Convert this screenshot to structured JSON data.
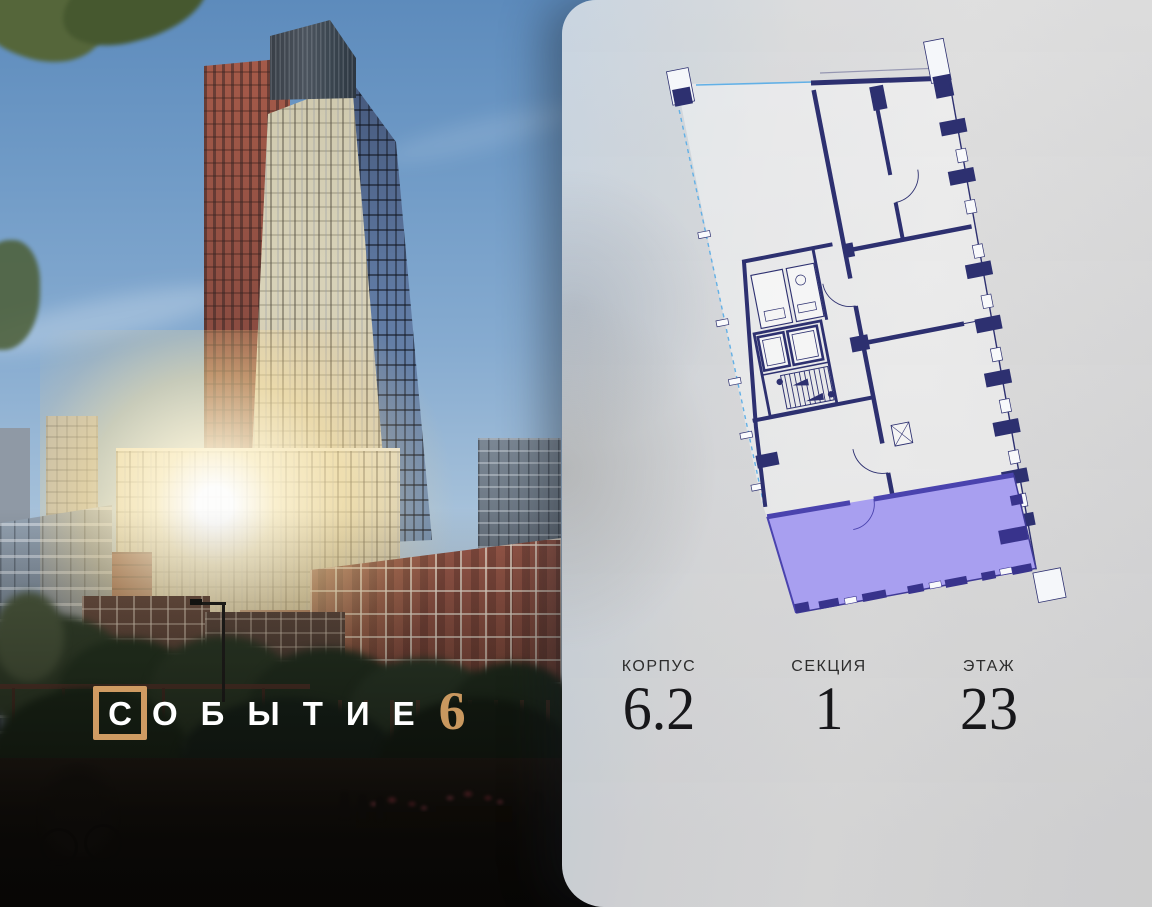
{
  "brand": {
    "boxed_letter": "С",
    "letters_rest": "ОБЫТИЕ",
    "suffix_number": "6",
    "accent_color": "#cf9b62"
  },
  "panel": {
    "info": [
      {
        "label": "КОРПУС",
        "value": "6.2"
      },
      {
        "label": "СЕКЦИЯ",
        "value": "1"
      },
      {
        "label": "ЭТАЖ",
        "value": "23"
      }
    ],
    "plan": {
      "highlighted_unit": "selected-apartment",
      "highlight_color": "#a89ff0",
      "highlight_wall_color": "#4a43ae",
      "wall_color": "#2d3070",
      "section_boundary_color": "#62b0e6"
    }
  }
}
